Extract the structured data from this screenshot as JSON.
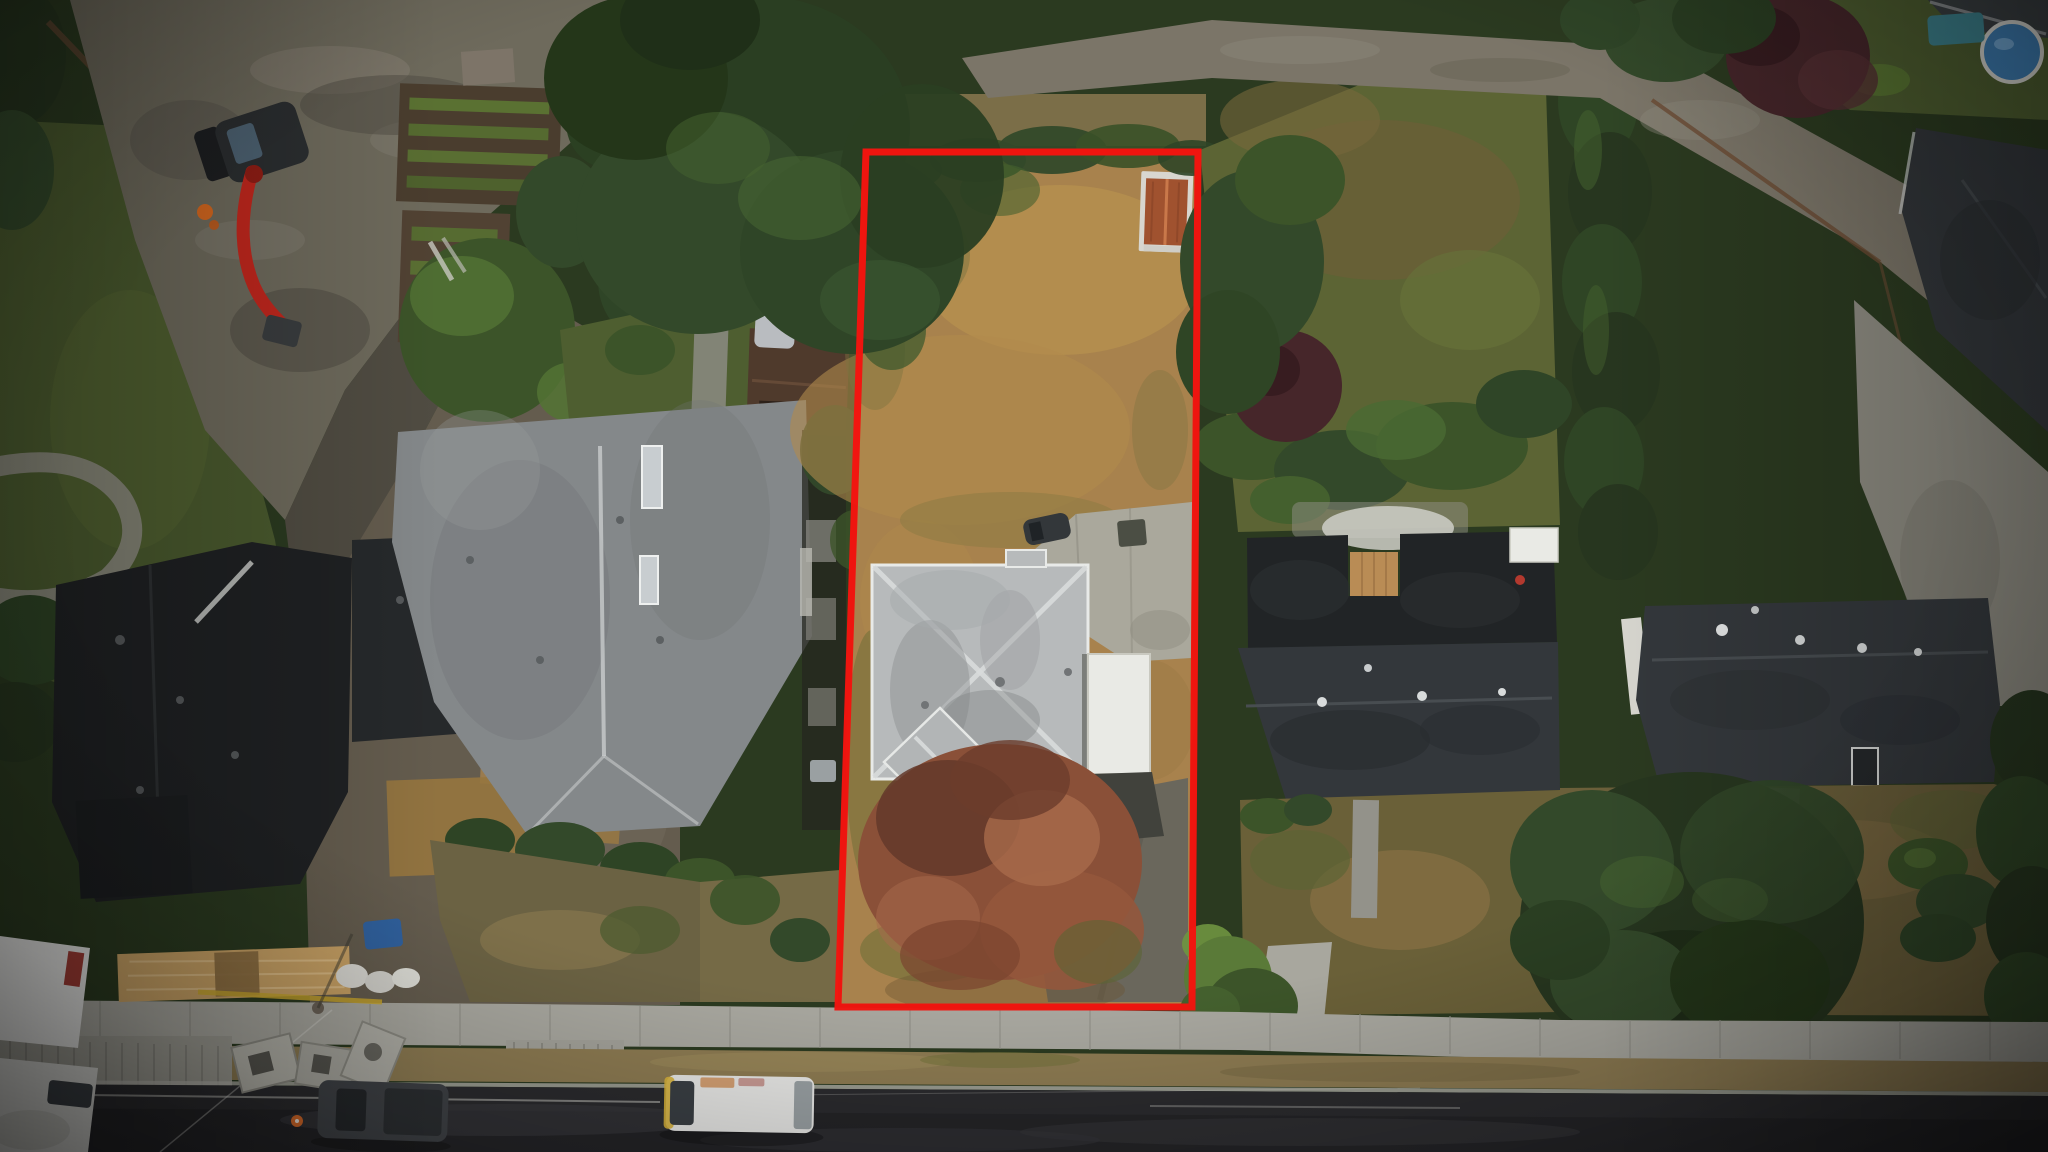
{
  "image": {
    "kind": "aerial-drone-photograph",
    "description": "Overhead drone view of a suburban residential block; one deep rectangular lot with a grey hip-roof house, dry tan lawn, autumn tree and shed is outlined in red as a property-boundary annotation.",
    "width_px": 2048,
    "height_px": 1152,
    "visible_text": ""
  },
  "annotation": {
    "name": "property-boundary",
    "shape": "quadrilateral",
    "color": "#f5140e",
    "stroke_px": 7
  },
  "palette": {
    "base_green": "#2b3a20",
    "red_outline": "#f5140e",
    "road_asphalt": "#2b2b2e",
    "road_dark": "#232326",
    "sidewalk": "#a8a79f",
    "sidewalk_joint": "#8f8e86",
    "apron": "#9d9c93",
    "curb": "#b5b4ac",
    "boulevard_dry": "#8d7b52",
    "lot_lawn": "#a8824d",
    "lot_lawn_light": "#b8934f",
    "lot_lawn_green": "#6f7038",
    "neighbor_lawn": "#4a5a2e",
    "yard_olive": "#5c6434",
    "front_dry": "#6b5f3a",
    "gravel": "#6e6a5c",
    "gravel_light": "#8d887a",
    "lane_gravel": "#7b7568",
    "dirt": "#645c4e",
    "drive_dark": "#504c42",
    "lumber": "#c9a265",
    "lumber_light": "#e0c18c",
    "plywood": "#9a7b4e",
    "osb_deck": "#96763f",
    "black_roof": "#1f2123",
    "dark_roof": "#33373b",
    "gray_roof": "#84888a",
    "gray_roof_light": "#b7babb",
    "ridge_light": "#d9dcdc",
    "white_surface": "#e9eae5",
    "concrete": "#aaa89c",
    "concrete_dark": "#93928a",
    "exit_drive": "#6a675c",
    "shed_roof": "#a0522f",
    "shed_trim": "#d8d6cf",
    "tree_dark": "#27361f",
    "tree_green": "#33492a",
    "tree_mid": "#3c5429",
    "tree_light": "#46632f",
    "tree_bright": "#6f9540",
    "autumn": "#8a5038",
    "autumn_dark": "#63382a",
    "autumn_light": "#a86a4b",
    "maroon_tree": "#46262a",
    "pool_blue": "#3f7fb5",
    "teal_table": "#3f8591",
    "excavator_red": "#c1271d",
    "safety_orange": "#d4671f",
    "cone_orange": "#d96b2a",
    "tarp_blue": "#30619e",
    "vehicle_white": "#e8e8e6",
    "van_yellow": "#d8b23a",
    "pickup_gray": "#3f4246",
    "brown_garage": "#4f3a2c",
    "fence_brown": "#6b4b33"
  },
  "scene": {
    "setting": "suburban street, overcast light, vignetted edges",
    "objects": [
      "outlined-lot",
      "subject-house-hip-roof",
      "attached-white-garage",
      "autumn-tree",
      "garden-shed",
      "lot-driveway",
      "large-conifer-tree",
      "left-neighbor-house",
      "construction-site",
      "excavator",
      "lumber-piles",
      "construction-house-black-roof",
      "garden-beds",
      "right-neighbor-house",
      "cedar-hedge-row",
      "rear-lane",
      "backyard-pool",
      "far-right-houses",
      "street",
      "sidewalk",
      "white-van",
      "white-trucks",
      "dark-pickup",
      "traffic-cone"
    ]
  }
}
